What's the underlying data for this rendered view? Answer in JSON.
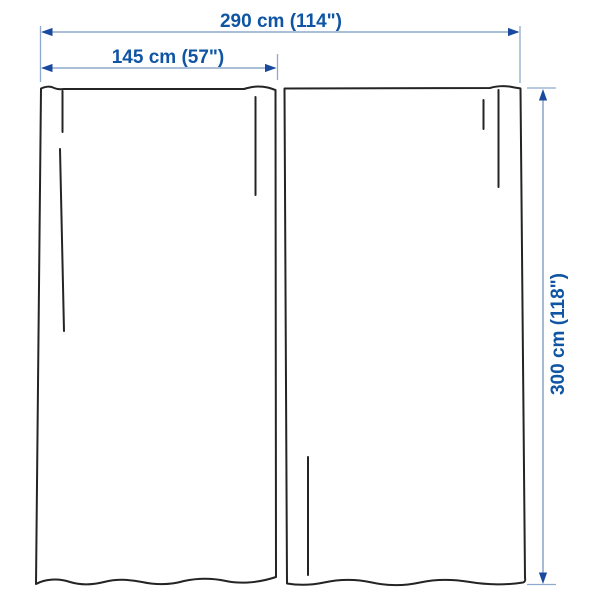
{
  "diagram": {
    "type": "product-dimension-diagram",
    "subject": "pair of curtain panels",
    "dimensions": {
      "total_width": "290 cm (114\")",
      "panel_width": "145 cm (57\")",
      "panel_height": "300 cm (118\")"
    },
    "colors": {
      "background": "#ffffff",
      "curtain_outline": "#242424",
      "dimension_line": "#8fa9cc",
      "arrowhead": "#1a4a9e",
      "dimension_text": "#0f55a3"
    }
  }
}
